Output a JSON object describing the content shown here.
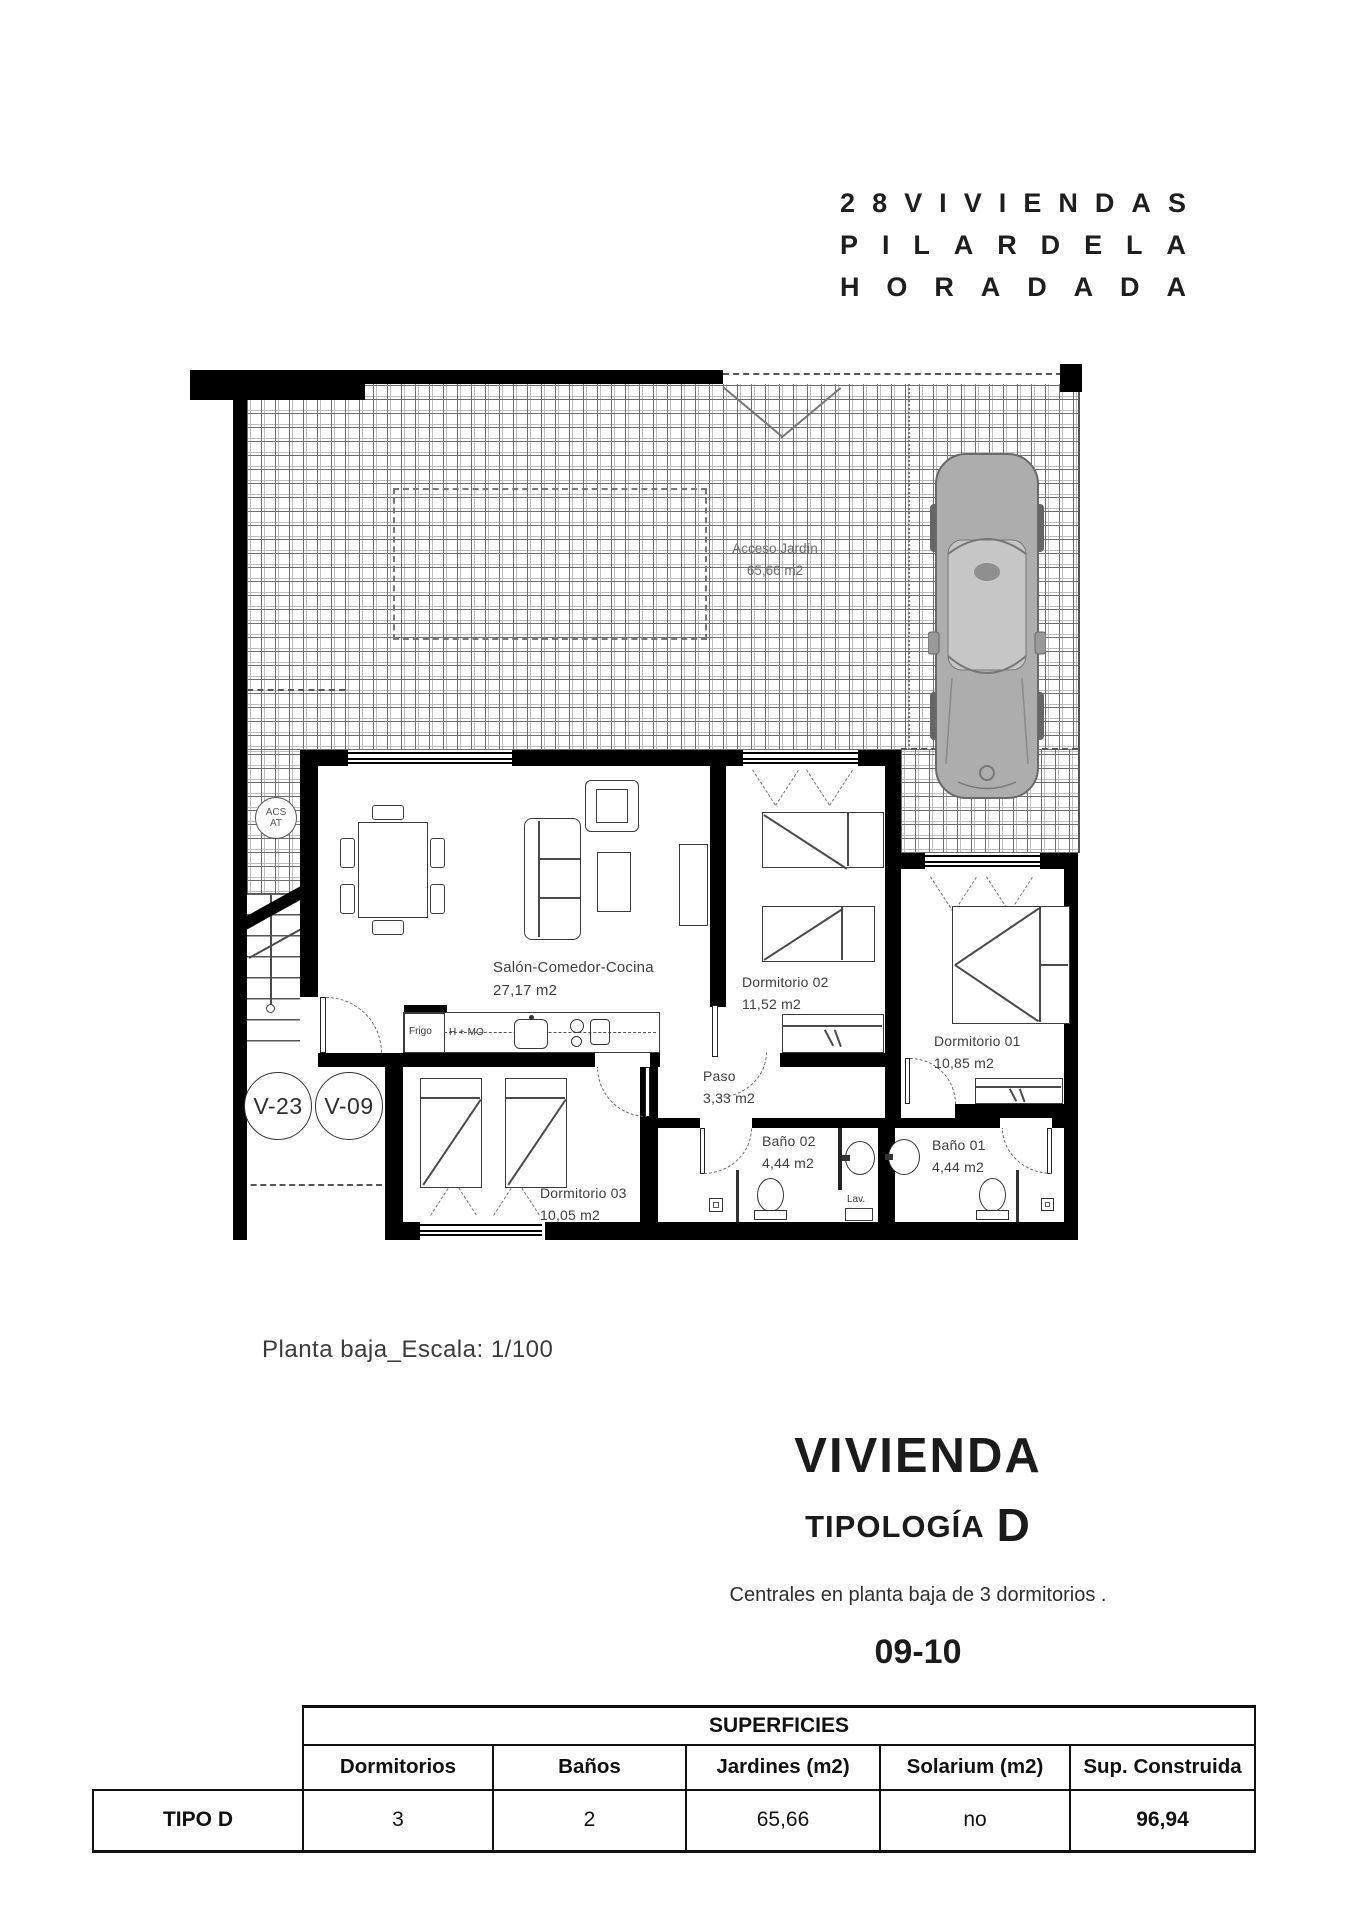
{
  "header": {
    "lines": [
      "28 VIVIENDAS",
      "PILAR DE LA",
      "HORADADA"
    ]
  },
  "plan": {
    "garden": {
      "name": "Acceso Jardín",
      "area": "65,66 m2"
    },
    "acs": {
      "line1": "ACS",
      "line2": "AT"
    },
    "badges": {
      "v1": "V-23",
      "v2": "V-09"
    },
    "rooms": {
      "salon": {
        "name": "Salón-Comedor-Cocina",
        "area": "27,17 m2"
      },
      "dorm01": {
        "name": "Dormitorio 01",
        "area": "10,85 m2"
      },
      "dorm02": {
        "name": "Dormitorio 02",
        "area": "11,52 m2"
      },
      "dorm03": {
        "name": "Dormitorio 03",
        "area": "10,05 m2"
      },
      "paso": {
        "name": "Paso",
        "area": "3,33 m2"
      },
      "bano01": {
        "name": "Baño 01",
        "area": "4,44 m2"
      },
      "bano02": {
        "name": "Baño 02",
        "area": "4,44 m2"
      }
    },
    "kitchen": {
      "fridge": "Frigo",
      "oven": "H + MO"
    },
    "laundry": "Lav."
  },
  "caption": "Planta baja_Escala: 1/100",
  "typology": {
    "title": "VIVIENDA",
    "subtitle": "TIPOLOGÍA",
    "letter": "D",
    "description": "Centrales en planta baja de 3 dormitorios .",
    "units": "09-10"
  },
  "table": {
    "title": "SUPERFICIES",
    "row_label": "TIPO D",
    "columns": [
      "Dormitorios",
      "Baños",
      "Jardines (m2)",
      "Solarium (m2)",
      "Sup. Construida"
    ],
    "values": [
      "3",
      "2",
      "65,66",
      "no",
      "96,94"
    ]
  }
}
